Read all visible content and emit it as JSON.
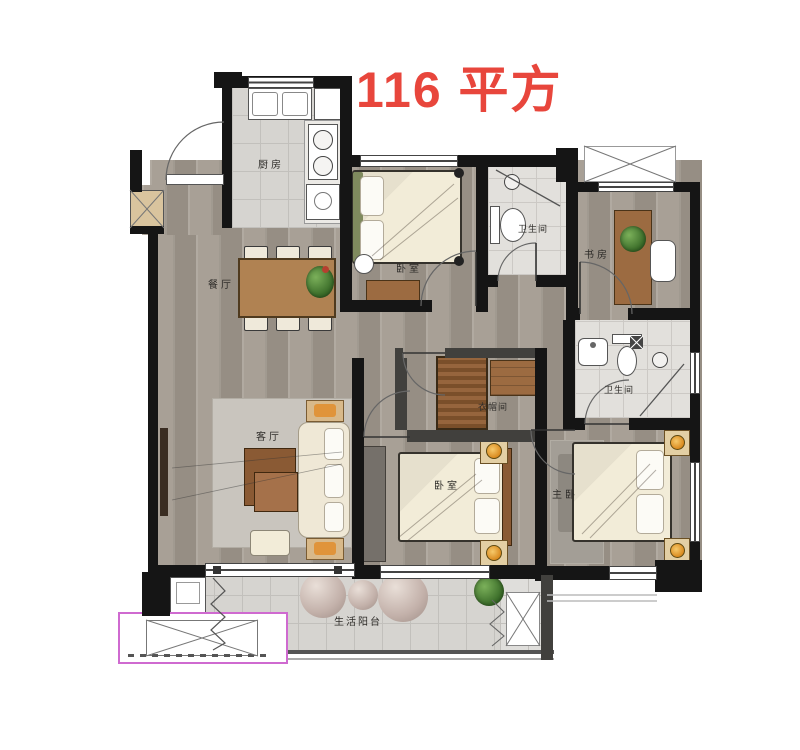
{
  "title": "116 平方",
  "colors": {
    "title_red": "#e8463c",
    "wall_black": "#151515",
    "wood_floor": "#a29a90",
    "tile_gray": "#d6d4d0",
    "bed_cream": "#f2ecd8",
    "furniture_wood": "#9c6b41",
    "lamp_orange": "#d98a1f",
    "plant_green": "#3c6e2a",
    "ac_platform_magenta": "#cf6ad0"
  },
  "rooms": {
    "kitchen": {
      "label": "厨房"
    },
    "dining": {
      "label": "餐厅"
    },
    "bedroom_top": {
      "label": "卧室"
    },
    "bath_top": {
      "label": "卫生间"
    },
    "study": {
      "label": "书房"
    },
    "living": {
      "label": "客厅"
    },
    "closet": {
      "label": "衣帽间"
    },
    "bedroom_second": {
      "label": "卧室"
    },
    "bath_master": {
      "label": "卫生间"
    },
    "master": {
      "label": "主卧"
    },
    "balcony": {
      "label": "生活阳台"
    }
  }
}
